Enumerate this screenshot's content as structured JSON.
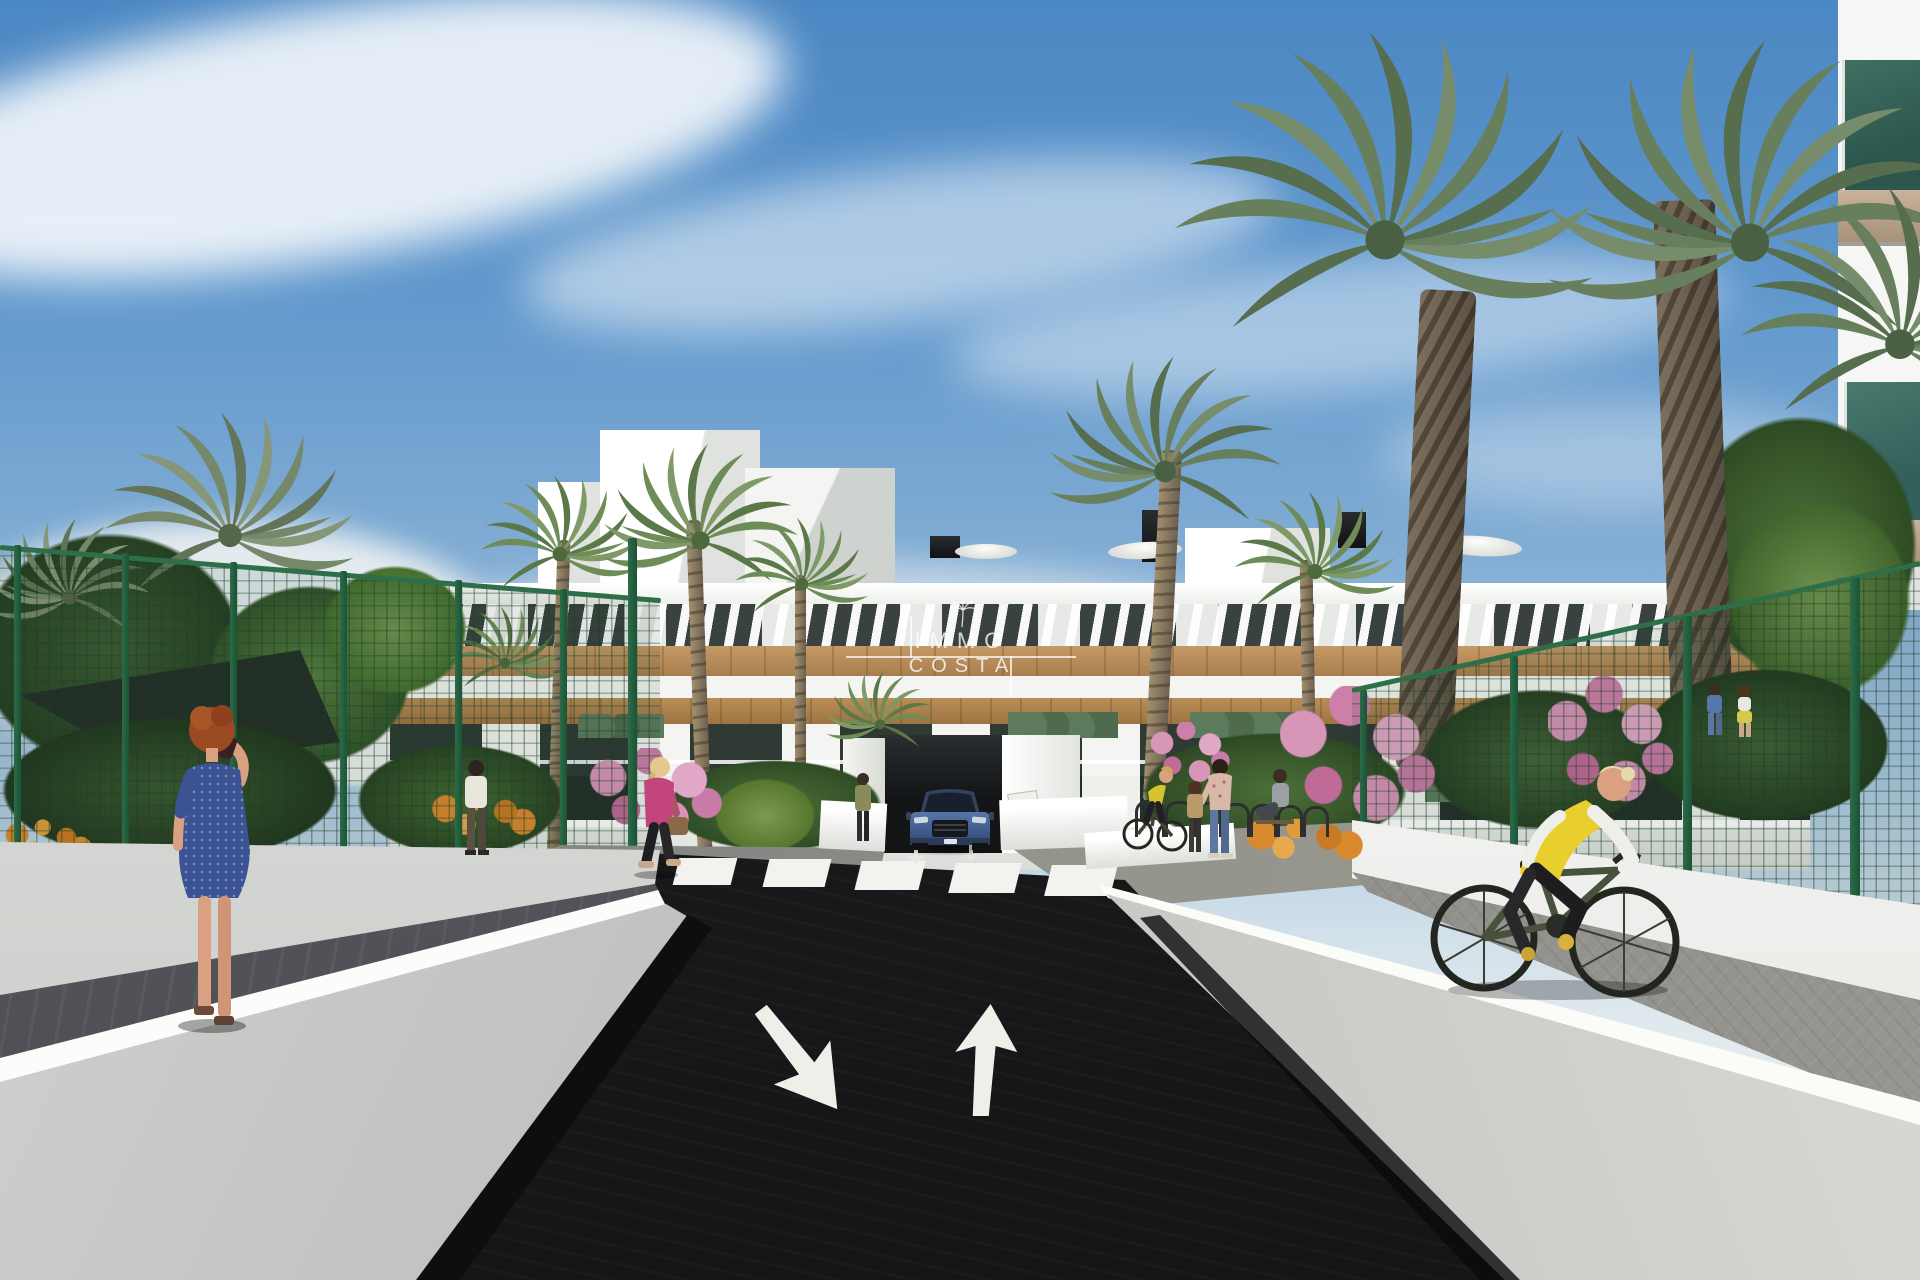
{
  "scene": {
    "type": "3d-architectural-render",
    "subject": "Street approach to a modern white Mediterranean apartment complex with palm trees, pedestrians, a cyclist and a blue car at the garage ramp",
    "watermark": {
      "icon": "palm-icon",
      "line1": "IMMO",
      "line2": "COSTA"
    },
    "palette": {
      "sky_top": "#4b87c3",
      "sky_haze": "#e4ebef",
      "building_white": "#f6f7f4",
      "wood_cladding": "#b8905a",
      "window_glass": "#333d38",
      "balcony_glass_teal": "#4a7a6e",
      "road_asphalt": "#1b1b1e",
      "wall_light": "#cfd1cf",
      "sidewalk_dark_gray": "#5a5b60",
      "paver_warm_gray": "#97958f",
      "fence_green": "#26603f",
      "palm_green": "#6d8a58",
      "flower_pink": "#d492b4",
      "flower_orange": "#d98a2e",
      "car_blue": "#46659e",
      "vest_yellow": "#ecd22f",
      "dress_blue": "#3a5494",
      "jacket_pink": "#c2457c"
    }
  }
}
